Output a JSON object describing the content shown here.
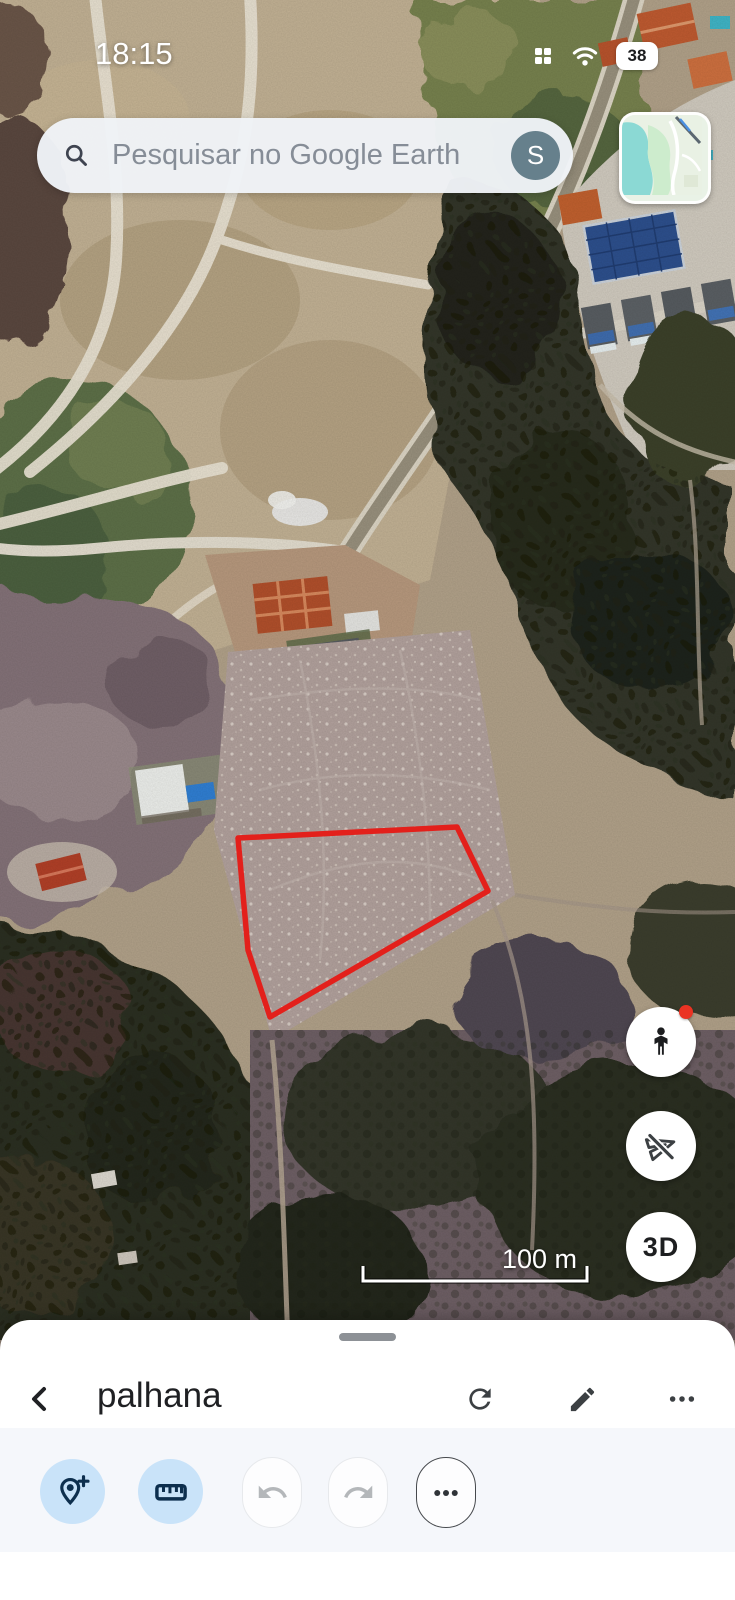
{
  "app": {
    "name": "Google Earth"
  },
  "status_bar": {
    "time": "18:15",
    "battery_percent": "38"
  },
  "search_bar": {
    "placeholder": "Pesquisar no Google Earth",
    "account_initial": "S"
  },
  "map": {
    "parcel_points": "238,838 457,827 488,891 270,1017 248,950",
    "parcel_color": "#e3201b",
    "scale_label": "100 m",
    "fab_3d_label": "3D",
    "fabs": [
      "street-view-pegman",
      "fly-disabled",
      "3d-toggle"
    ]
  },
  "bottom_sheet": {
    "title": "palhana",
    "header_actions": [
      "refresh",
      "edit",
      "more"
    ],
    "toolbar_actions": [
      "add-placemark",
      "measure",
      "undo",
      "redo",
      "more"
    ]
  },
  "colors": {
    "toolbar_active_bg": "#c9e3f9",
    "toolbar_active_icon": "#0d2f4e",
    "avatar_bg": "#66808c",
    "parcel_outline": "#e3201b"
  }
}
